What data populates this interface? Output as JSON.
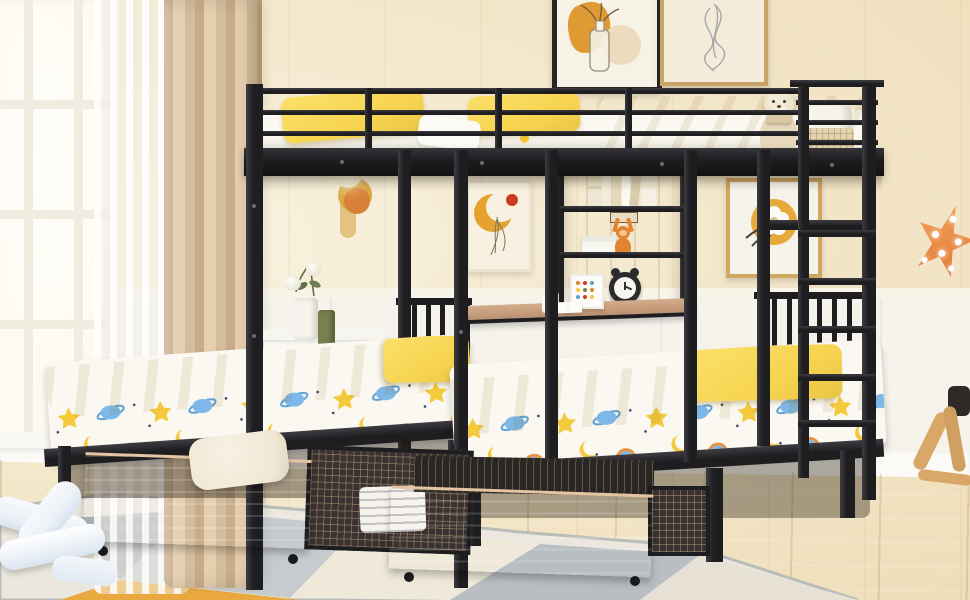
{
  "scene": {
    "type": "product-photo",
    "room": "kids bedroom",
    "subject": "black metal triple bunk bed (full over two twins) with under-bed storage drawers, built-in shelves and desk",
    "objects": [
      "window",
      "sheer-curtain",
      "tan-curtain",
      "wall-art-vase",
      "wall-art-line-figure",
      "wall-art-crescent-moon",
      "wall-art-gold-flower",
      "wall-sconce",
      "star-lamp",
      "teddy-bear",
      "bookshelf",
      "alarm-clock",
      "plush-monkey",
      "desk",
      "pen-cup",
      "photo-frame",
      "open-book",
      "nightstand",
      "flower-vases",
      "upper-bunk",
      "lower-twin-bed-left",
      "lower-twin-bed-right",
      "storage-drawer-left",
      "storage-drawer-right",
      "ladder",
      "area-rug",
      "plush-knot-pillows",
      "floor-pillow",
      "rocking-horse",
      "wood-floor"
    ]
  },
  "palette": {
    "wall": "#f3e7ca",
    "wainscot": "#f6f3ec",
    "chair_rail": "#f8f4e8",
    "floor": "#ddb77f",
    "floor_light": "#e9cfa0",
    "rug": "#ebe7de",
    "rug_gray": "#a9aeb4",
    "rug_gray_light": "#c6cbce",
    "rug_orange": "#e9a93e",
    "curtain": "#d5bd9c",
    "curtain_light": "#e4d0b1",
    "metal": "#1e1e21",
    "metal_hi": "#3d3d42",
    "bedding_yellow": "#f7d450",
    "blanket_fold": "#e4bf3a",
    "mattress_white": "#fbf8f1",
    "wood": "#d3ad8b",
    "wood_dark": "#bb9171",
    "shelf_back": "#c29c7d",
    "teddy": "#ecdfc6",
    "star_lamp": "#e98a45",
    "plush_blue": "#edf2f8",
    "pillow_cream": "#f0e8d6",
    "clock": "#2b2b2e",
    "monkey": "#e08430",
    "vase_green": "#76814f",
    "motif_yellow": "#f5c93c",
    "motif_blue": "#7db8e8",
    "accent_red": "#cc3b20",
    "art_orange": "#e09a33"
  }
}
